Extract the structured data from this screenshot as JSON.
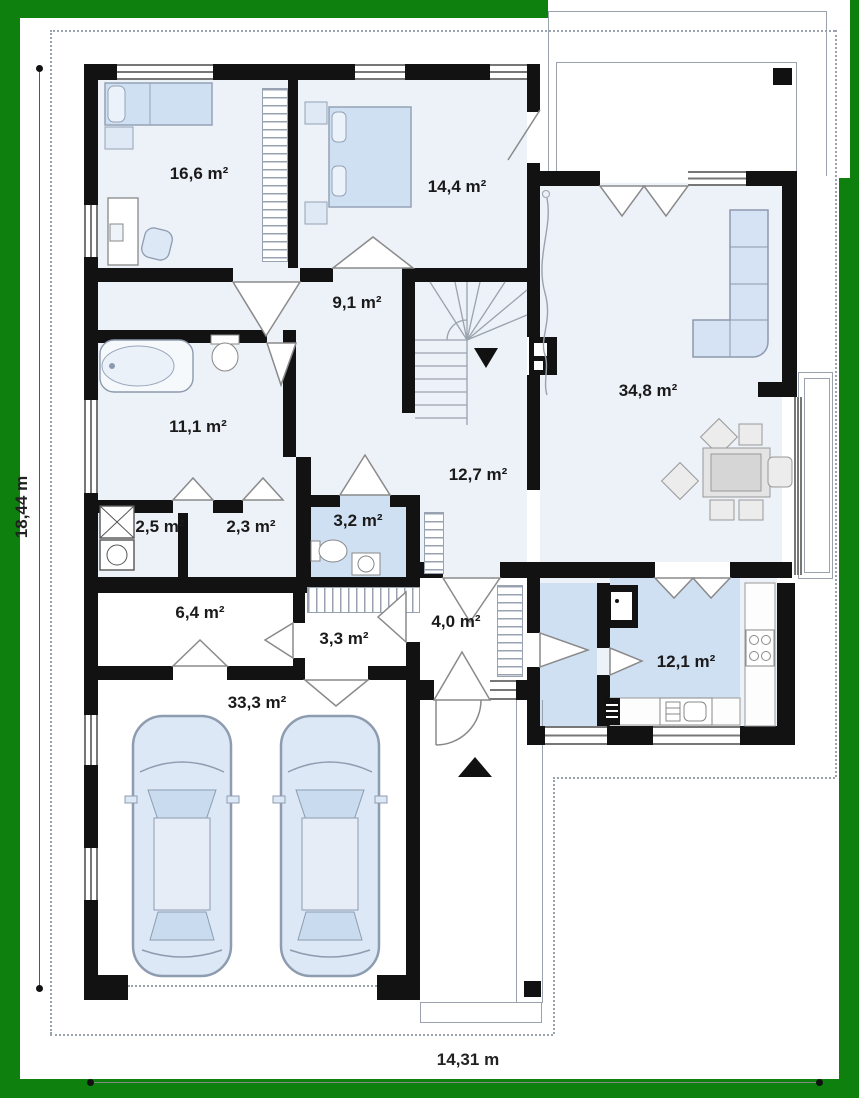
{
  "plan": {
    "title": "single-family house ground floor plan",
    "rooms": [
      {
        "id": "bedroom-1",
        "area": "16,6 m²"
      },
      {
        "id": "bedroom-2",
        "area": "14,4 m²"
      },
      {
        "id": "hall-upper",
        "area": "9,1 m²"
      },
      {
        "id": "living-room",
        "area": "34,8 m²"
      },
      {
        "id": "bathroom",
        "area": "11,1 m²"
      },
      {
        "id": "hall-main",
        "area": "12,7 m²"
      },
      {
        "id": "laundry",
        "area": "2,5 m²"
      },
      {
        "id": "storage",
        "area": "2,3 m²"
      },
      {
        "id": "wc",
        "area": "3,2 m²"
      },
      {
        "id": "corridor",
        "area": "6,4 m²"
      },
      {
        "id": "hall-small",
        "area": "3,3 m²"
      },
      {
        "id": "vestibule",
        "area": "4,0 m²"
      },
      {
        "id": "garage",
        "area": "33,3 m²"
      },
      {
        "id": "kitchen",
        "area": "12,1 m²"
      }
    ],
    "dimensions": {
      "width": "14,31 m",
      "height": "18,44 m"
    },
    "colors": {
      "frame": "#0e800e",
      "wall": "#121212",
      "floor": "#edf1f8",
      "floor_accent": "#cfe0f2",
      "furniture": "#d5e3f4",
      "outline": "#8d99ad"
    }
  }
}
